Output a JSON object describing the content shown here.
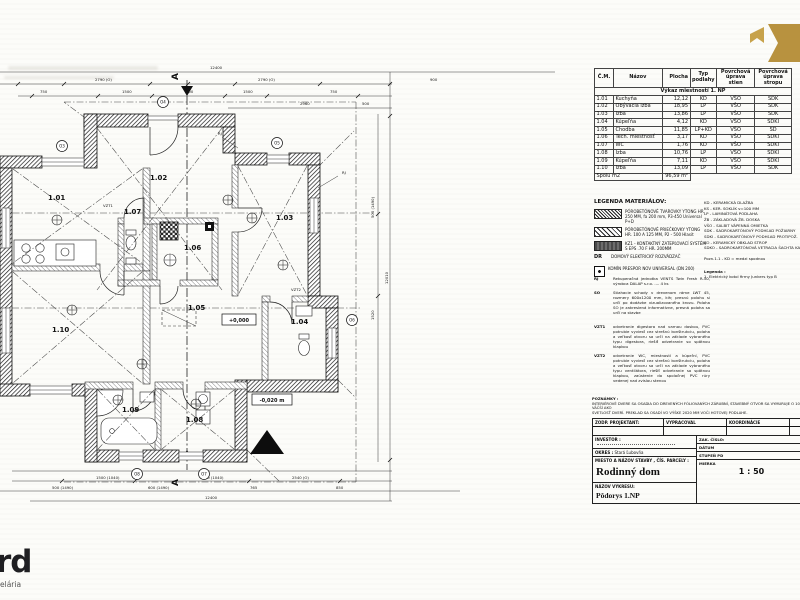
{
  "room_table": {
    "headers": [
      "Č.M.",
      "Názov",
      "Plocha",
      "Typ podlahy",
      "Povrchová úprava stien",
      "Povrchová úprava stropu"
    ],
    "section_title": "Výkaz miestností 1. NP",
    "rows": [
      {
        "num": "1.01",
        "name": "Kuchyňa",
        "area": "12,12",
        "floor": "KD",
        "walls": "VŠO",
        "ceiling": "SDK"
      },
      {
        "num": "1.02",
        "name": "Obývacia izba",
        "area": "18,95",
        "floor": "LP",
        "walls": "VŠO",
        "ceiling": "SDK"
      },
      {
        "num": "1.03",
        "name": "Izba",
        "area": "13,86",
        "floor": "LP",
        "walls": "VŠO",
        "ceiling": "SDK"
      },
      {
        "num": "1.04",
        "name": "Kúpeľňa",
        "area": "4,12",
        "floor": "KD",
        "walls": "VŠO",
        "ceiling": "SDKI"
      },
      {
        "num": "1.05",
        "name": "Chodba",
        "area": "11,85",
        "floor": "LP+KD",
        "walls": "VŠO",
        "ceiling": "SD"
      },
      {
        "num": "1.06",
        "name": "Tech. miestnosť",
        "area": "3,17",
        "floor": "KD",
        "walls": "VŠO",
        "ceiling": "SDKI"
      },
      {
        "num": "1.07",
        "name": "WC",
        "area": "1,76",
        "floor": "KD",
        "walls": "VŠO",
        "ceiling": "SDKI"
      },
      {
        "num": "1.08",
        "name": "Izba",
        "area": "10,76",
        "floor": "LP",
        "walls": "VŠO",
        "ceiling": "SDKI"
      },
      {
        "num": "1.09",
        "name": "Kúpeľňa",
        "area": "7,11",
        "floor": "KD",
        "walls": "VŠO",
        "ceiling": "SDKI"
      },
      {
        "num": "1.10",
        "name": "Izba",
        "area": "13,09",
        "floor": "LP",
        "walls": "VŠO",
        "ceiling": "SDK"
      }
    ],
    "footer_label": "Spolu m2",
    "footer_value": "96,59 m²"
  },
  "legend": {
    "title": "LEGENDA MATERIÁLOV:",
    "items": [
      {
        "text": "PÓROBETÓNOVÉ TVAROVKY YTONG HR. 250 MM, fa 200 mm, P3-450 Universal P+D"
      },
      {
        "text": "PÓROBETÓNOVÉ PRIEČKOVKY YTONG HR. 100 A 125 MM, P2 - 500 Hlasit"
      },
      {
        "text": "KZ1 - KONTAKTNÝ ZATEPĽOVACÍ SYSTÉM S EPS .70 F HR. 200MM"
      },
      {
        "prefix": "DR",
        "text": "DOMOVÝ ELEKTRICKÝ ROZVÁDZAČ"
      },
      {
        "text": "KOMÍN PRESPOR NOV UNIVERSAL (DN 200)"
      }
    ],
    "abbreviations": [
      "KD  -  KERAMICKÁ DLAŽBA",
      "KS  -  KER. SOKLÍK v=100 MM",
      "LP  -  LAMINÁTOVÁ PODLAHA",
      "ŽB  -  ZÁKLADOVÁ ŽB. DOSKA",
      "VŠO - SALBIT VÁPENNÁ OMIETKA",
      "SDK - SADROKARTÓNOVÝ PODHĽAD POŽIARNY",
      "SDKI - SADROKARTÓNOVÝ PODHĽAD PROTIPOŽ.",
      "KO  -  KERAMICKÝ OBKLAD STROP",
      "SDKO - SADROKARTÓNOVÁ VETRACIA ŠACHTA KANALIZÁCIE"
    ],
    "pozn_line": "Pozn.1.1 - KD = medzi spodnou",
    "legenda2_title": "Legenda :",
    "legenda2_item": "1. Elektrický kotol firmy Junkers typ B"
  },
  "notes": [
    {
      "key": "RJ",
      "text": "Rekuperačná jednotka VENTS Twin Fresh R-50, výrobca DALAP s.r.o. .... 4 ks"
    },
    {
      "key": "SO",
      "text": "Stiahacie schody v drevenom ráme LWT 45, rozmery 600x1200 mm, kih; presnú polohu si určí po dodávke vizualizovaného krovu. Poloha SO je zakreslená informatívne, presná poloha sa určí na stavbe"
    },
    {
      "key": "VZT1",
      "text": "odvetranie digestora nad varnou doskou, PVC potrubie vyviesť cez strešnú konštrukciu, poloha a veľkosť otvoru sa určí na základe vybraného typu digestora, riešiť odvetranie so spätnou klapkou"
    },
    {
      "key": "VZT2",
      "text": "odvetranie WC, miestností a kúpeľní, PVC potrubie vyviesť cez strešnú konštrukciu, poloha a veľkosť otvoru sa určí na základe vybraného typu ventilátora, riešiť odvetranie so spätnou klapkou, zaústenie do spoločnej PVC rúry vedenej nad zvislou stenou"
    }
  ],
  "title_block": {
    "remarks_label": "POZNÁMKY :",
    "remarks_line1": "INTERIÉROVÉ DVERE SA OSADIA DO DREVENÝCH FÓLIOVANÝCH ZÁRUBNÍ, STAVEBNÝ OTVOR SA VYMURUJE O 10 CM VÄČŠÍ AKO",
    "remarks_line2": "SVETLOSŤ DVERÍ. PREKLAD SA OSADÍ VO VÝŠKE 2020 MM VOČI HOTOVEJ PODLAHE.",
    "col1": "ZODP. PROJEKTANT:",
    "col2": "VYPRACOVAL",
    "col3": "KOORDINÁCIE",
    "investor_label": "INVESTOR :",
    "okres_label": "OKRES :",
    "okres_value": "Stará Ľubovňa",
    "site_label": "MIESTO A NÁZOV STAVBY , ČÍS. PARCELY :",
    "project_name": "Rodinný dom",
    "drawing_label": "NÁZOV VÝKRESU:",
    "drawing_name": "Pôdorys 1.NP",
    "zak_cislo_label": "ZAK. ČÍSLO:",
    "datum_label": "DÁTUM",
    "stupen_label": "STUPEŇ PD",
    "mierka_label": "MIERKA",
    "mierka_value": "1 : 50"
  },
  "plan": {
    "rooms": [
      {
        "id": "1.01"
      },
      {
        "id": "1.02"
      },
      {
        "id": "1.03"
      },
      {
        "id": "1.04"
      },
      {
        "id": "1.05"
      },
      {
        "id": "1.06"
      },
      {
        "id": "1.07"
      },
      {
        "id": "1.08"
      },
      {
        "id": "1.09"
      },
      {
        "id": "1.10"
      }
    ],
    "elevation_main": "+0,000",
    "elevation_out": "-0,020 m",
    "section_letter": "A",
    "dim_labels": [
      {
        "x": 210,
        "y": 11,
        "t": "12400"
      },
      {
        "x": 95,
        "y": 23,
        "t": "2790 (O)"
      },
      {
        "x": 258,
        "y": 23,
        "t": "2790 (O)"
      },
      {
        "x": 430,
        "y": 23,
        "t": "900"
      },
      {
        "x": 40,
        "y": 35,
        "t": "750"
      },
      {
        "x": 122,
        "y": 35,
        "t": "1500"
      },
      {
        "x": 186,
        "y": 35,
        "t": "900"
      },
      {
        "x": 243,
        "y": 35,
        "t": "1500"
      },
      {
        "x": 330,
        "y": 35,
        "t": "750"
      },
      {
        "x": 300,
        "y": 47,
        "t": "2960"
      },
      {
        "x": 362,
        "y": 47,
        "t": "500"
      },
      {
        "x": 218,
        "y": 77,
        "t": "RJ"
      },
      {
        "x": 342,
        "y": 116,
        "t": "RJ"
      },
      {
        "x": 103,
        "y": 149,
        "t": "VZT1"
      },
      {
        "x": 291,
        "y": 233,
        "t": "VZT2"
      },
      {
        "x": 96,
        "y": 421,
        "t": "1500 (1040)"
      },
      {
        "x": 200,
        "y": 421,
        "t": "1500 (1040)"
      },
      {
        "x": 292,
        "y": 421,
        "t": "2540 (O)"
      },
      {
        "x": 52,
        "y": 431,
        "t": "500 (1490)"
      },
      {
        "x": 148,
        "y": 431,
        "t": "600 (1490)"
      },
      {
        "x": 250,
        "y": 431,
        "t": "765"
      },
      {
        "x": 336,
        "y": 431,
        "t": "850"
      },
      {
        "x": 205,
        "y": 441,
        "t": "12400"
      },
      {
        "x": 374,
        "y": 160,
        "t": "500 (1490)",
        "r": -90
      },
      {
        "x": 374,
        "y": 262,
        "t": "1520",
        "r": -90
      },
      {
        "x": 388,
        "y": 226,
        "t": "12010",
        "r": -90
      }
    ],
    "markers": [
      {
        "x": 62,
        "y": 88,
        "t": "O3"
      },
      {
        "x": 163,
        "y": 44,
        "t": "O4"
      },
      {
        "x": 277,
        "y": 85,
        "t": "O5"
      },
      {
        "x": 352,
        "y": 262,
        "t": "O6"
      },
      {
        "x": 137,
        "y": 416,
        "t": "O8"
      },
      {
        "x": 204,
        "y": 416,
        "t": "O7"
      }
    ],
    "symbols": [
      {
        "x": 228,
        "y": 142
      },
      {
        "x": 283,
        "y": 207
      },
      {
        "x": 142,
        "y": 306
      },
      {
        "x": 196,
        "y": 346
      },
      {
        "x": 118,
        "y": 342
      },
      {
        "x": 72,
        "y": 252
      },
      {
        "x": 57,
        "y": 162
      },
      {
        "x": 252,
        "y": 160
      }
    ]
  },
  "logos": {
    "corner_fragment": "rd",
    "corner_sub": "elária",
    "gold_color": "#c7a24b",
    "gold_color2": "#b8923f"
  }
}
